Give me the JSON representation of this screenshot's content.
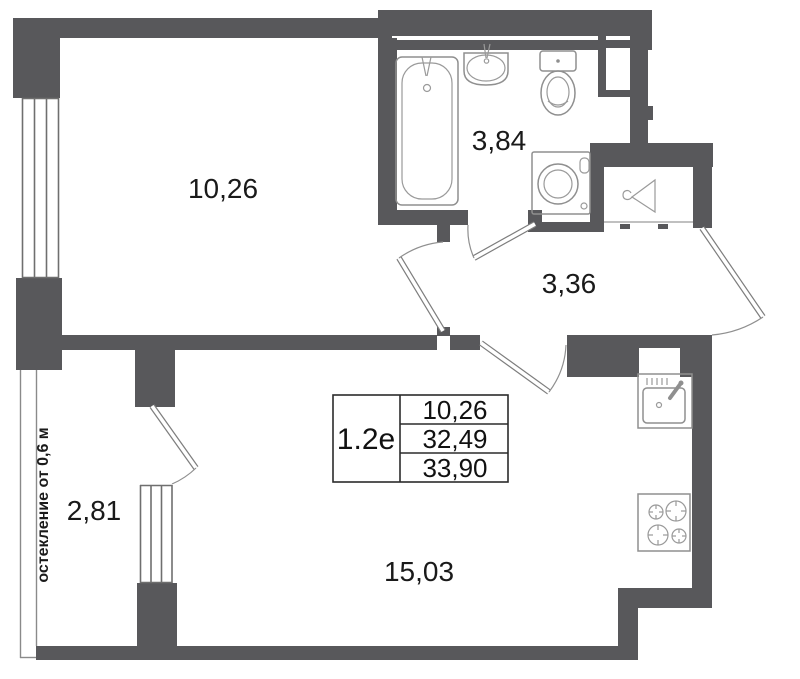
{
  "title": "apartment floor plan",
  "colors": {
    "wall": "#58585B",
    "fixture_outline": "#8f8f8f",
    "text": "#1a1a1a"
  },
  "rooms": {
    "bedroom": {
      "area": "10,26"
    },
    "bathroom": {
      "area": "3,84"
    },
    "hallway": {
      "area": "3,36"
    },
    "balcony": {
      "area": "2,81"
    },
    "kitchen_living": {
      "area": "15,03"
    }
  },
  "annotations": {
    "glazing_note": "остекление от 0,6 м"
  },
  "info_table": {
    "unit_type": "1.2е",
    "rows": [
      "10,26",
      "32,49",
      "33,90"
    ]
  },
  "icons": [
    "bathtub-icon",
    "wash-basin-icon",
    "toilet-icon",
    "washing-machine-icon",
    "hanger-icon",
    "kitchen-sink-icon",
    "stove-icon"
  ]
}
